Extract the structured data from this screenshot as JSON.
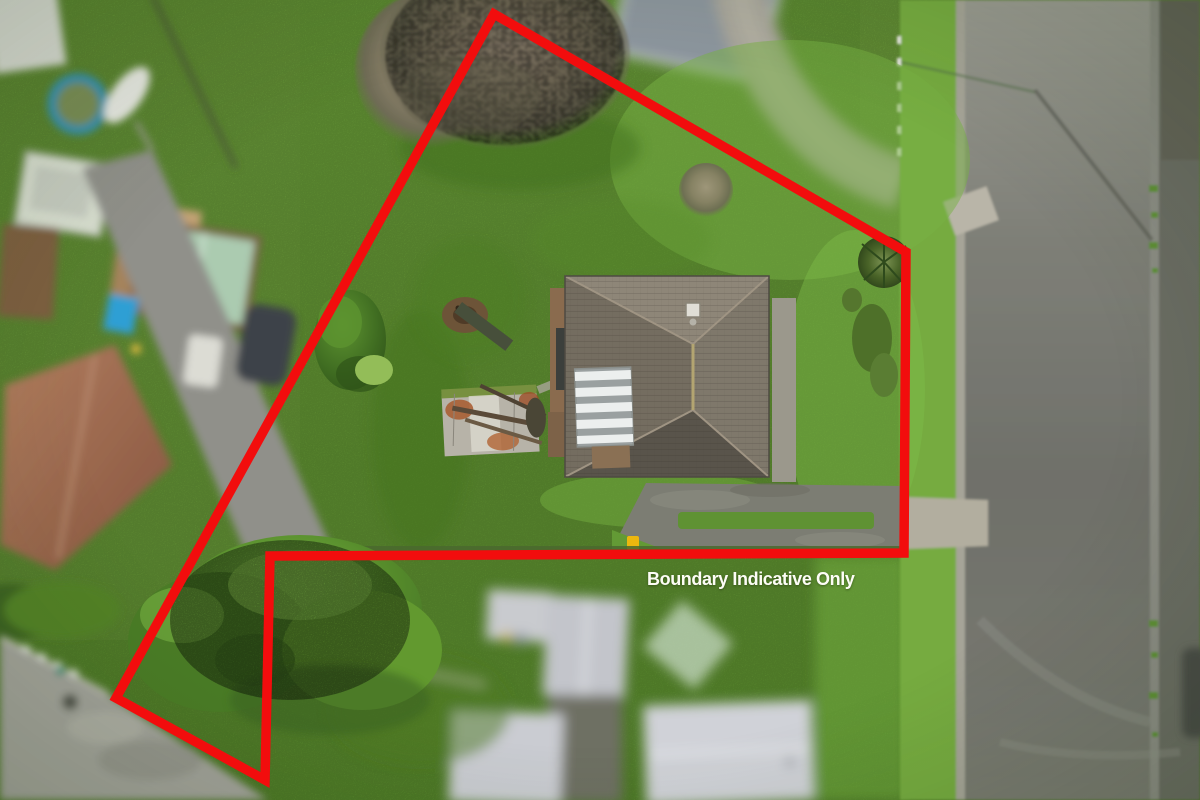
{
  "annotation": {
    "label": "Boundary Indicative Only",
    "color": "#fdfdf6"
  },
  "overlay": {
    "boundary_color": "#f20d0d",
    "boundary_stroke_width": 9.5,
    "boundary_points": [
      [
        494,
        14
      ],
      [
        906,
        252
      ],
      [
        904,
        553
      ],
      [
        270,
        556
      ],
      [
        265,
        780
      ],
      [
        116,
        698
      ]
    ]
  },
  "scene": {
    "type": "aerial-drone-photo",
    "subject": "residential property outlined in red",
    "palette": {
      "lawn_green": "#69a236",
      "roof_grey": "#7f786b",
      "road_asphalt": "#7b7c74",
      "shed_rust": "#a85a2e"
    }
  }
}
